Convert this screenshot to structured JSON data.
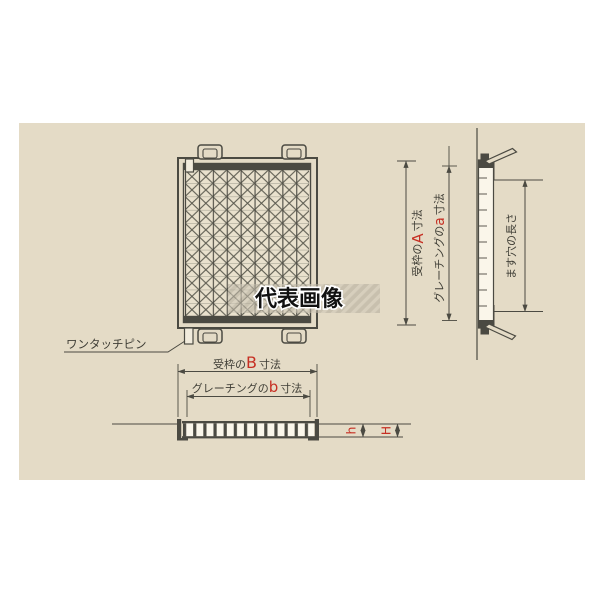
{
  "watermark": {
    "text": "代表画像"
  },
  "labels": {
    "one_touch_pin": "ワンタッチピン",
    "masu_hole": "ます穴の長さ"
  },
  "dims": {
    "A": {
      "prefix": "受枠の",
      "var": "A",
      "suffix": "寸法"
    },
    "a": {
      "prefix": "グレーチングの",
      "var": "a",
      "suffix": "寸法"
    },
    "B": {
      "prefix": "受枠の",
      "var": "B",
      "suffix": "寸法"
    },
    "b": {
      "prefix": "グレーチングの",
      "var": "b",
      "suffix": "寸法"
    },
    "h": {
      "var": "h"
    },
    "H": {
      "var": "H"
    }
  },
  "colors": {
    "panel_bg": "#e4dbc6",
    "line": "#4b4a42",
    "text": "#3f3e36",
    "accent_red": "#c62f23",
    "watermark_text": "#111111",
    "hatch_base": "#b7b0a0",
    "hatch_stripe": "#cfc8b8"
  }
}
